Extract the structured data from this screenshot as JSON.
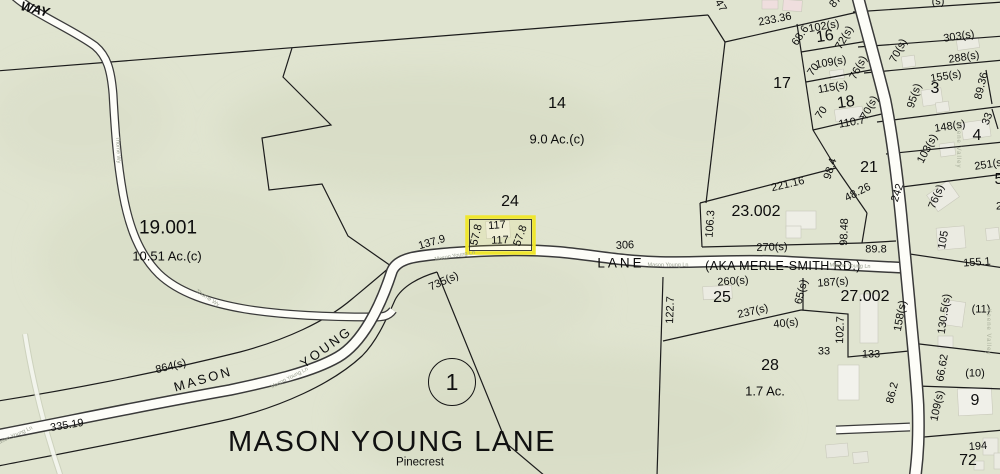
{
  "map": {
    "title": "MASON YOUNG LANE",
    "circle_marker": "1",
    "background_color": "#e0e4d0",
    "highlight_color": "#efe62e",
    "selected_parcel": {
      "block": "24",
      "front": "117",
      "rear": "117",
      "left_side": "57.8",
      "right_side": "57.8"
    },
    "labels": [
      {
        "t": "WAY",
        "x": 35,
        "y": 9,
        "r": 14,
        "c": "way"
      },
      {
        "t": "19.001",
        "x": 168,
        "y": 228,
        "r": 0,
        "c": "lg"
      },
      {
        "t": "10.51 Ac.(c)",
        "x": 167,
        "y": 256,
        "r": 0,
        "c": "sm"
      },
      {
        "t": "14",
        "x": 557,
        "y": 104,
        "r": 0,
        "c": "md"
      },
      {
        "t": "9.0 Ac.(c)",
        "x": 557,
        "y": 139,
        "r": 0,
        "c": "sm"
      },
      {
        "t": "24",
        "x": 510,
        "y": 202,
        "r": 0,
        "c": "md"
      },
      {
        "t": "17",
        "x": 782,
        "y": 84,
        "r": 0,
        "c": "md"
      },
      {
        "t": "16",
        "x": 825,
        "y": 37,
        "r": -8,
        "c": "md"
      },
      {
        "t": "18",
        "x": 846,
        "y": 103,
        "r": -8,
        "c": "md"
      },
      {
        "t": "21",
        "x": 869,
        "y": 168,
        "r": 0,
        "c": "md"
      },
      {
        "t": "23.002",
        "x": 756,
        "y": 212,
        "r": 0,
        "c": "md"
      },
      {
        "t": "3",
        "x": 935,
        "y": 89,
        "r": 0,
        "c": "md"
      },
      {
        "t": "4",
        "x": 977,
        "y": 136,
        "r": 0,
        "c": "md"
      },
      {
        "t": "25",
        "x": 722,
        "y": 298,
        "r": 0,
        "c": "md"
      },
      {
        "t": "27.002",
        "x": 865,
        "y": 297,
        "r": 0,
        "c": "md"
      },
      {
        "t": "28",
        "x": 770,
        "y": 366,
        "r": 0,
        "c": "md"
      },
      {
        "t": "1.7 Ac.",
        "x": 765,
        "y": 391,
        "r": 0,
        "c": "sm"
      },
      {
        "t": "9",
        "x": 975,
        "y": 401,
        "r": 0,
        "c": "md"
      },
      {
        "t": "72",
        "x": 968,
        "y": 461,
        "r": 0,
        "c": "md"
      },
      {
        "t": "5",
        "x": 999,
        "y": 180,
        "r": 0,
        "c": "md"
      },
      {
        "t": "(11)",
        "x": 981,
        "y": 310,
        "r": 0,
        "c": "dim"
      },
      {
        "t": "(10)",
        "x": 975,
        "y": 374,
        "r": 0,
        "c": "dim"
      },
      {
        "t": "Pinecrest",
        "x": 420,
        "y": 463,
        "r": 0,
        "c": "pine"
      },
      {
        "t": "MASON",
        "x": 203,
        "y": 379,
        "r": -16,
        "c": "road"
      },
      {
        "t": "YOUNG",
        "x": 326,
        "y": 347,
        "r": -36,
        "c": "road"
      },
      {
        "t": "LANE",
        "x": 621,
        "y": 263,
        "r": 0,
        "c": "roadsp"
      },
      {
        "t": "(AKA MERLE-SMITH RD.)",
        "x": 783,
        "y": 266,
        "r": 0,
        "c": "sm2"
      },
      {
        "t": "233.36",
        "x": 775,
        "y": 20,
        "r": -11,
        "c": "dim"
      },
      {
        "t": "47",
        "x": 720,
        "y": 6,
        "r": 60,
        "c": "dim"
      },
      {
        "t": "68.6",
        "x": 801,
        "y": 36,
        "r": -55,
        "c": "dim"
      },
      {
        "t": "102(s)",
        "x": 824,
        "y": 27,
        "r": -10,
        "c": "dim"
      },
      {
        "t": "72(s)",
        "x": 845,
        "y": 38,
        "r": -60,
        "c": "dim"
      },
      {
        "t": "109(s)",
        "x": 831,
        "y": 63,
        "r": -10,
        "c": "dim"
      },
      {
        "t": "70",
        "x": 814,
        "y": 70,
        "r": -55,
        "c": "dim"
      },
      {
        "t": "76(s)",
        "x": 859,
        "y": 68,
        "r": -62,
        "c": "dim"
      },
      {
        "t": "115(s)",
        "x": 833,
        "y": 88,
        "r": -10,
        "c": "dim"
      },
      {
        "t": "70",
        "x": 822,
        "y": 113,
        "r": -55,
        "c": "dim"
      },
      {
        "t": "70(s)",
        "x": 870,
        "y": 108,
        "r": -62,
        "c": "dim"
      },
      {
        "t": "110.7",
        "x": 852,
        "y": 123,
        "r": -10,
        "c": "dim"
      },
      {
        "t": "98.4",
        "x": 831,
        "y": 169,
        "r": -72,
        "c": "dim"
      },
      {
        "t": "221.16",
        "x": 788,
        "y": 185,
        "r": -13,
        "c": "dim"
      },
      {
        "t": "48.26",
        "x": 858,
        "y": 193,
        "r": -27,
        "c": "dim"
      },
      {
        "t": "106.3",
        "x": 711,
        "y": 224,
        "r": -86,
        "c": "dim"
      },
      {
        "t": "98.48",
        "x": 845,
        "y": 232,
        "r": -88,
        "c": "dim"
      },
      {
        "t": "270(s)",
        "x": 772,
        "y": 248,
        "r": -2,
        "c": "dim"
      },
      {
        "t": "89.8",
        "x": 876,
        "y": 250,
        "r": 0,
        "c": "dim"
      },
      {
        "t": "242",
        "x": 898,
        "y": 193,
        "r": -72,
        "c": "dim"
      },
      {
        "t": "303(s)",
        "x": 959,
        "y": 37,
        "r": -9,
        "c": "dim"
      },
      {
        "t": "70(s)",
        "x": 899,
        "y": 51,
        "r": -62,
        "c": "dim"
      },
      {
        "t": "288(s)",
        "x": 964,
        "y": 58,
        "r": -9,
        "c": "dim"
      },
      {
        "t": "155(s)",
        "x": 946,
        "y": 77,
        "r": -9,
        "c": "dim"
      },
      {
        "t": "95(s)",
        "x": 915,
        "y": 96,
        "r": -72,
        "c": "dim"
      },
      {
        "t": "89.36",
        "x": 982,
        "y": 86,
        "r": -76,
        "c": "dim"
      },
      {
        "t": "33",
        "x": 988,
        "y": 119,
        "r": -70,
        "c": "dim"
      },
      {
        "t": "148(s)",
        "x": 950,
        "y": 127,
        "r": -9,
        "c": "dim"
      },
      {
        "t": "103(s)",
        "x": 928,
        "y": 149,
        "r": -62,
        "c": "dim"
      },
      {
        "t": "251(s)",
        "x": 990,
        "y": 165,
        "r": -9,
        "c": "dim"
      },
      {
        "t": "76(s)",
        "x": 937,
        "y": 197,
        "r": -68,
        "c": "dim"
      },
      {
        "t": "105",
        "x": 944,
        "y": 240,
        "r": -80,
        "c": "dim"
      },
      {
        "t": "155.1",
        "x": 977,
        "y": 263,
        "r": -4,
        "c": "dim"
      },
      {
        "t": "130.5(s)",
        "x": 945,
        "y": 314,
        "r": -82,
        "c": "dim"
      },
      {
        "t": "66.62",
        "x": 943,
        "y": 368,
        "r": -80,
        "c": "dim"
      },
      {
        "t": "109(s)",
        "x": 938,
        "y": 406,
        "r": -78,
        "c": "dim"
      },
      {
        "t": "194",
        "x": 978,
        "y": 447,
        "r": -4,
        "c": "dim"
      },
      {
        "t": "86.2",
        "x": 893,
        "y": 393,
        "r": -76,
        "c": "dim"
      },
      {
        "t": "158(s)",
        "x": 901,
        "y": 316,
        "r": -80,
        "c": "dim"
      },
      {
        "t": "102.7",
        "x": 841,
        "y": 330,
        "r": -88,
        "c": "dim"
      },
      {
        "t": "187(s)",
        "x": 833,
        "y": 283,
        "r": -4,
        "c": "dim"
      },
      {
        "t": "260(s)",
        "x": 733,
        "y": 282,
        "r": -4,
        "c": "dim"
      },
      {
        "t": "65(s)",
        "x": 802,
        "y": 292,
        "r": -76,
        "c": "dim"
      },
      {
        "t": "122.7",
        "x": 671,
        "y": 310,
        "r": -88,
        "c": "dim"
      },
      {
        "t": "237(s)",
        "x": 753,
        "y": 312,
        "r": -13,
        "c": "dim"
      },
      {
        "t": "40(s)",
        "x": 786,
        "y": 324,
        "r": -6,
        "c": "dim"
      },
      {
        "t": "306",
        "x": 625,
        "y": 246,
        "r": -3,
        "c": "dim"
      },
      {
        "t": "137.9",
        "x": 432,
        "y": 243,
        "r": -16,
        "c": "dim"
      },
      {
        "t": "117",
        "x": 497,
        "y": 226,
        "r": -4,
        "c": "dim"
      },
      {
        "t": "117",
        "x": 500,
        "y": 241,
        "r": -2,
        "c": "dim"
      },
      {
        "t": "57.8",
        "x": 477,
        "y": 235,
        "r": -76,
        "c": "dim"
      },
      {
        "t": "57.8",
        "x": 521,
        "y": 236,
        "r": -70,
        "c": "dim"
      },
      {
        "t": "735(s)",
        "x": 444,
        "y": 282,
        "r": -24,
        "c": "dim"
      },
      {
        "t": "864(s)",
        "x": 171,
        "y": 367,
        "r": -14,
        "c": "dim"
      },
      {
        "t": "335.19",
        "x": 67,
        "y": 426,
        "r": -9,
        "c": "dim"
      },
      {
        "t": "33",
        "x": 824,
        "y": 352,
        "r": 0,
        "c": "dim"
      },
      {
        "t": "133",
        "x": 871,
        "y": 355,
        "r": 0,
        "c": "dim"
      },
      {
        "t": "87",
        "x": 836,
        "y": 2,
        "r": -50,
        "c": "dim"
      },
      {
        "t": "(s)",
        "x": 938,
        "y": 2,
        "r": 0,
        "c": "dim"
      },
      {
        "t": "2",
        "x": 999,
        "y": 207,
        "r": 0,
        "c": "dim"
      },
      {
        "t": "Mason Young Ln",
        "x": 455,
        "y": 257,
        "r": -10,
        "c": "tiny"
      },
      {
        "t": "Mason Young Ln",
        "x": 668,
        "y": 266,
        "r": 0,
        "c": "tiny"
      },
      {
        "t": "Mason Young Ln",
        "x": 850,
        "y": 267,
        "r": 2,
        "c": "tiny"
      },
      {
        "t": "Mason Young Ln",
        "x": 290,
        "y": 379,
        "r": -27,
        "c": "tiny"
      },
      {
        "t": "Mason Young Ln",
        "x": 14,
        "y": 437,
        "r": -24,
        "c": "tiny"
      },
      {
        "t": "Thorne Wy",
        "x": 117,
        "y": 150,
        "r": 87,
        "c": "tiny"
      },
      {
        "t": "Thorne Wy",
        "x": 207,
        "y": 299,
        "r": 33,
        "c": "tiny"
      },
      {
        "t": "Keene Valley",
        "x": 958,
        "y": 145,
        "r": 90,
        "c": "tinyv"
      },
      {
        "t": "Keene Valley",
        "x": 988,
        "y": 332,
        "r": 90,
        "c": "tinyv"
      }
    ]
  }
}
